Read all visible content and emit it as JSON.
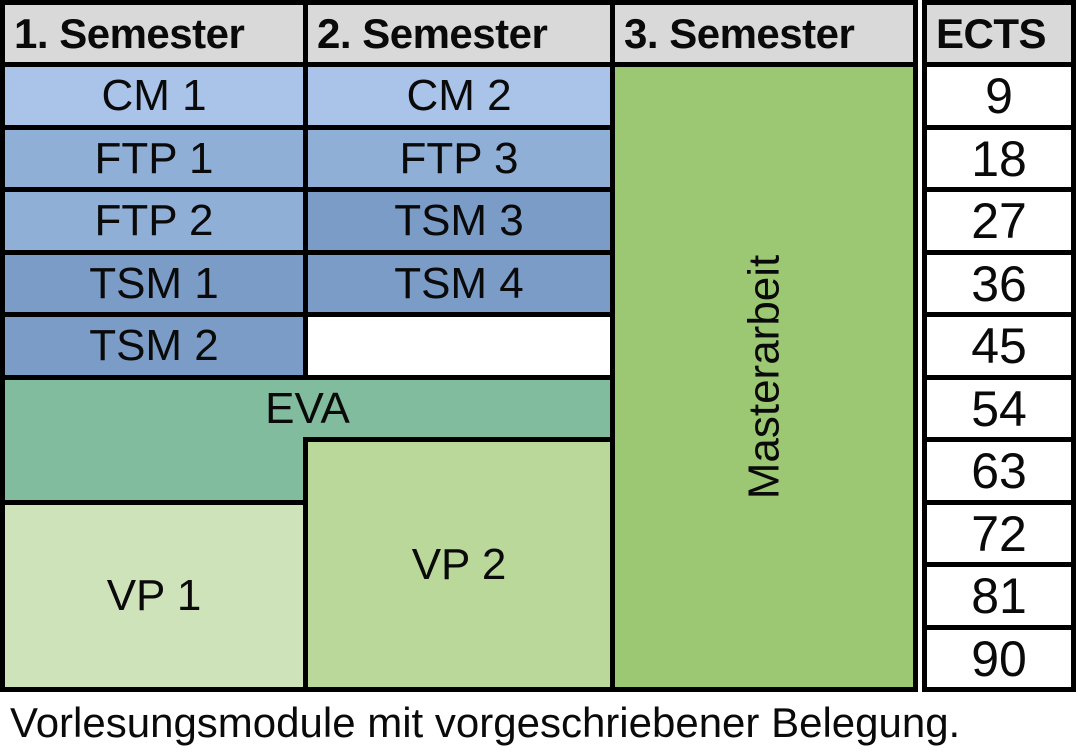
{
  "headers": {
    "sem1": "1. Semester",
    "sem2": "2. Semester",
    "sem3": "3. Semester",
    "ects": "ECTS"
  },
  "modules": {
    "sem1": [
      "CM 1",
      "FTP 1",
      "FTP 2",
      "TSM 1",
      "TSM 2"
    ],
    "sem2": [
      "CM 2",
      "FTP 3",
      "TSM 3",
      "TSM 4"
    ],
    "eva": "EVA",
    "vp1": "VP 1",
    "vp2": "VP 2",
    "masterarbeit": "Masterarbeit"
  },
  "ects_values": [
    "9",
    "18",
    "27",
    "36",
    "45",
    "54",
    "63",
    "72",
    "81",
    "90"
  ],
  "caption": "Vorlesungsmodule mit vorgeschriebener Belegung.",
  "colors": {
    "header_bg": "#d9d9d9",
    "cm": "#a9c4e8",
    "ftp": "#8fafd6",
    "tsm": "#7a9cc6",
    "eva": "#82bc9e",
    "vp1": "#cfe3bb",
    "vp2": "#b9d89a",
    "masterarbeit": "#9cc873",
    "empty_cell": "#ffffff",
    "ects_cell": "#ffffff",
    "border": "#000000",
    "text": "#0a0a0a"
  }
}
